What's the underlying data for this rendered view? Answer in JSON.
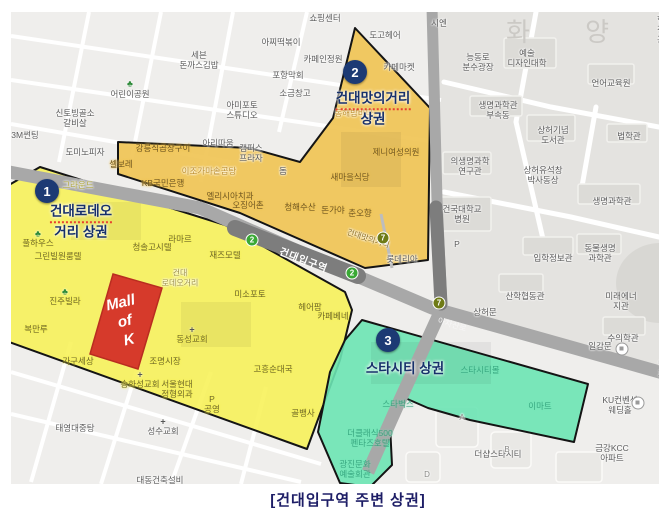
{
  "caption": "[건대입구역 주변 상권]",
  "district_label": "화 양 동",
  "colors": {
    "zone1_yellow": "#f7f156",
    "zone2_orange": "#f0c455",
    "zone3_green": "#6ce4b4",
    "mall_red": "#d63a2b",
    "badge_navy": "#1c3a74",
    "caption_navy": "#1d1d66",
    "line2_green": "#3aa935",
    "line7_olive": "#6f7b16"
  },
  "zones": [
    {
      "number": "1",
      "line1": "건대로데오",
      "line2": "거리 상권"
    },
    {
      "number": "2",
      "line1": "건대맛의거리",
      "line2": "상권"
    },
    {
      "number": "3",
      "line1": "스타시티 상권",
      "line2": ""
    }
  ],
  "landmark": {
    "line1": "Mall",
    "line2": "of",
    "line3": "K"
  },
  "station": {
    "name": "건대입구역",
    "line2": "2",
    "line7": "7"
  },
  "road": {
    "name": "아차산로"
  },
  "icons": {
    "tree": "♣",
    "cross": "+"
  },
  "labels": [
    {
      "text": "쇼핑센터"
    },
    {
      "text": "아찌떡볶이"
    },
    {
      "text": "세븐\n돈까스김밥"
    },
    {
      "text": "카페인정원"
    },
    {
      "text": "포항막회"
    },
    {
      "text": "도고헤어"
    },
    {
      "text": "시엔"
    },
    {
      "text": "카페마켓"
    },
    {
      "text": "소금창고"
    },
    {
      "text": "아미포토\n스튜디오"
    },
    {
      "text": "어린이공원"
    },
    {
      "text": "신토빙골소\n갈비살"
    },
    {
      "text": "3M썬팅"
    },
    {
      "text": "도미노피자"
    },
    {
      "text": "아리따움"
    },
    {
      "text": "캠퍼스\n프라자"
    },
    {
      "text": "돔"
    },
    {
      "text": "강릉식곱창구이"
    },
    {
      "text": "셀보레"
    },
    {
      "text": "이조가마솥곰탕"
    },
    {
      "text": "KB국민은행"
    },
    {
      "text": "엘리시아치과"
    },
    {
      "text": "오징어촌"
    },
    {
      "text": "청해수산"
    },
    {
      "text": "돈가야"
    },
    {
      "text": "춘오향"
    },
    {
      "text": "새마을식당"
    },
    {
      "text": "동해밤바다"
    },
    {
      "text": "제니여성의원"
    },
    {
      "text": "건대맛의거리"
    },
    {
      "text": "능동로\n분수광장"
    },
    {
      "text": "예술\n디자인대학"
    },
    {
      "text": "언어교육원"
    },
    {
      "text": "행정관"
    },
    {
      "text": "생명과학관\n부속동"
    },
    {
      "text": "상허기념\n도서관"
    },
    {
      "text": "법학관"
    },
    {
      "text": "의생명과학\n연구관"
    },
    {
      "text": "상허유석창\n박사동상"
    },
    {
      "text": "생명과학관"
    },
    {
      "text": "건국대학교\n병원"
    },
    {
      "text": "입학정보관"
    },
    {
      "text": "동물생명\n과학관"
    },
    {
      "text": "미래에너지관"
    },
    {
      "text": "산학협동관"
    },
    {
      "text": "상허문"
    },
    {
      "text": "수의학관"
    },
    {
      "text": "일감문"
    },
    {
      "text": "롯데리아"
    },
    {
      "text": "그라운드"
    },
    {
      "text": "풀하우스"
    },
    {
      "text": "그린빌원룸텔"
    },
    {
      "text": "청솔고시텔"
    },
    {
      "text": "라마르"
    },
    {
      "text": "건대\n로데오거리"
    },
    {
      "text": "재즈모텔"
    },
    {
      "text": "미소포토"
    },
    {
      "text": "헤어팜"
    },
    {
      "text": "카페베네"
    },
    {
      "text": "진주빌라"
    },
    {
      "text": "복만루"
    },
    {
      "text": "가구세상"
    },
    {
      "text": "송화성교회"
    },
    {
      "text": "동성교회"
    },
    {
      "text": "조명시장"
    },
    {
      "text": "서울현대\n정형외과"
    },
    {
      "text": "P\n공영"
    },
    {
      "text": "고흥순대국"
    },
    {
      "text": "골뱅사"
    },
    {
      "text": "태영대중탕"
    },
    {
      "text": "성수교회"
    },
    {
      "text": "대동건축설비"
    },
    {
      "text": "스타시티몰"
    },
    {
      "text": "스타벅스"
    },
    {
      "text": "이마트"
    },
    {
      "text": "더클래식500\n펜타즈호텔"
    },
    {
      "text": "광진문화\n예술회관"
    },
    {
      "text": "더샵스타시티"
    },
    {
      "text": "금강KCC\n아파트"
    },
    {
      "text": "KU컨벤션\n웨딩홀"
    },
    {
      "text": "먹자"
    },
    {
      "text": "A"
    },
    {
      "text": "B"
    },
    {
      "text": "D"
    },
    {
      "text": "P"
    }
  ]
}
